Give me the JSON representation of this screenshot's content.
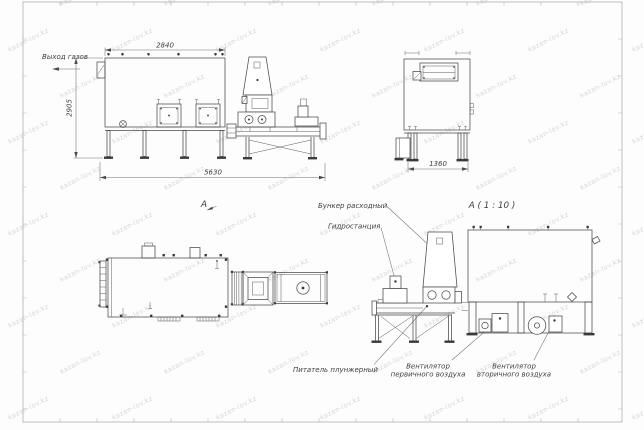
{
  "watermark": {
    "text": "kazan-lov.kz",
    "color": "#d4d6d6"
  },
  "side_view": {
    "gas_outlet": "Выход газов",
    "dim_top": "2840",
    "dim_left": "2905",
    "dim_bottom": "5630",
    "marker": "А"
  },
  "front_view": {
    "dim_bottom": "1360"
  },
  "detail_view": {
    "title": "А ( 1 : 10 )",
    "hopper_label": "Бункер расходный",
    "hydraulic_label": "Гидростанция",
    "feeder_label": "Питатель плунжерный",
    "primary_fan_label_1": "Вентилятор",
    "primary_fan_label_2": "первичного воздуха",
    "secondary_fan_label_1": "Вентилятор",
    "secondary_fan_label_2": "вторичного воздуха"
  },
  "colors": {
    "line": "#4a4a4a",
    "dim": "#707070",
    "sheet_frame": "#a3a3a3"
  }
}
